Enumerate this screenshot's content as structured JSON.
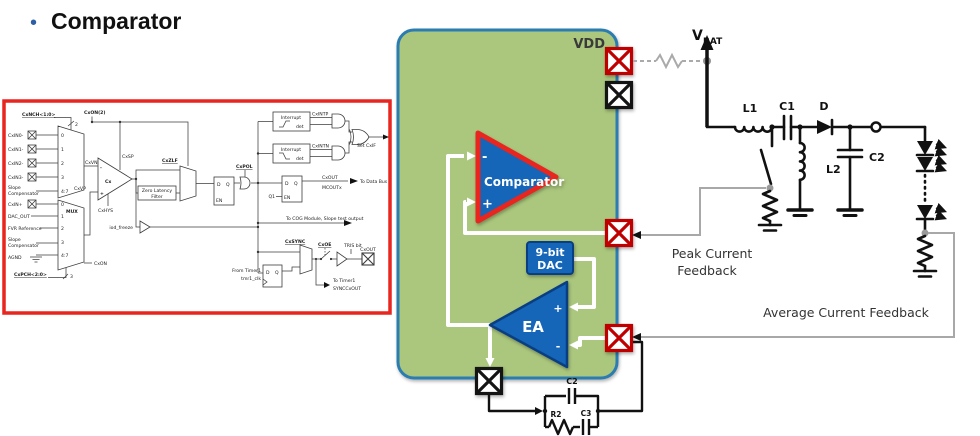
{
  "title": {
    "bullet": "•",
    "text": "Comparator"
  },
  "chip": {
    "vdd": "VDD",
    "comparator_label": "Comparator",
    "comp_minus": "-",
    "comp_plus": "+",
    "dac_line1": "9-bit",
    "dac_line2": "DAC",
    "ea_label": "EA",
    "ea_plus": "+",
    "ea_minus": "-"
  },
  "circuit": {
    "vbat_main": "V",
    "vbat_sub": "BAT",
    "l1": "L1",
    "c1": "C1",
    "d": "D",
    "l2": "L2",
    "c2": "C2",
    "comp_c2": "C2",
    "comp_r2": "R2",
    "comp_c3": "C3",
    "peak_line1": "Peak Current",
    "peak_line2": "Feedback",
    "avg": "Average Current Feedback"
  },
  "left": {
    "cxnch": "CxNCH<1:0>",
    "bus2": "2",
    "cxon_top": "CxON(2)",
    "cxin0": "CxIN0-",
    "cxin1": "CxIN1-",
    "cxin2": "CxIN2-",
    "cxin3": "CxIN3-",
    "m1_0": "0",
    "m1_1": "1",
    "m1_2": "2",
    "m1_3": "3",
    "m1_47": "4:7",
    "slope1a": "Slope",
    "slope1b": "Compensator",
    "cxvn": "CxVN",
    "cxvp": "CxVP",
    "cxsp": "CxSP",
    "cx": "Cx",
    "cxhys": "CxHYS",
    "comp_minus": "-",
    "comp_plus": "+",
    "cxinp": "CxIN+",
    "dacout": "DAC_OUT",
    "fvr": "FVR Reference",
    "slope2a": "Slope",
    "slope2b": "Compensator",
    "agnd": "AGND",
    "mux": "MUX",
    "m2_0": "0",
    "m2_1": "1",
    "m2_2": "2",
    "m2_3": "3",
    "m2_47": "4:7",
    "cxpch": "CxPCH<2:0>",
    "bus3": "3",
    "cxon": "CxON",
    "iod": "iod_freeze",
    "zlf1": "Zero Latency",
    "zlf2": "Filter",
    "cxzlf": "CxZLF",
    "ff1_d": "D",
    "ff1_q": "Q",
    "ff1_en": "EN",
    "cxpol": "CxPOL",
    "int1": "Interrupt",
    "det1": "det",
    "cxintp": "CxINTP",
    "int2": "Interrupt",
    "det2": "det",
    "cxintn": "CxINTN",
    "setcxif": "Set CxIF",
    "ff2_d": "D",
    "ff2_q": "Q",
    "ff2_en": "EN",
    "q1": "Q1",
    "cxout1": "CxOUT",
    "mcout": "MCOUTx",
    "databus": "To Data Bus",
    "cog": "To COG Module, Slope test output",
    "cxsync": "CxSYNC",
    "fft_d": "D",
    "fft_q": "Q",
    "fromtimer1": "From Timer1",
    "tmr1clk": "tmr1_clk",
    "cxoe": "CxOE",
    "trisbit": "TRIS bit",
    "cxoutpin": "CxOUT",
    "totimer1": "To Timer1",
    "synccxout": "SYNCCxOUT"
  },
  "colors": {
    "accent_red": "#e8251f",
    "chip_fill": "#abc77d",
    "chip_border": "#2b7cb0",
    "block_blue": "#1565b8",
    "block_blue_dark": "#0a3e82",
    "wire_gray": "#a8a8a8",
    "pin_red": "#c00000"
  }
}
